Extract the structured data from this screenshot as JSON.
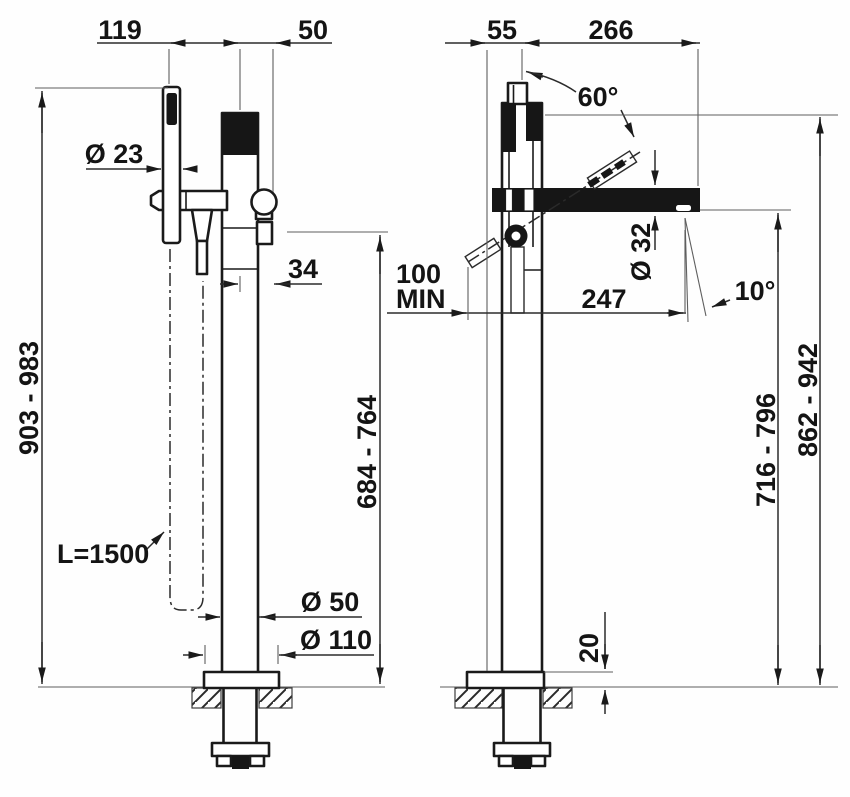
{
  "colors": {
    "ink": "#1a1a1a",
    "background": "#ffffff"
  },
  "dims": {
    "left": {
      "offset_handshower": "119",
      "offset_spout": "50",
      "dia_handshower": "Ø 23",
      "offset_outlet": "34",
      "height_total": "903 - 983",
      "height_spout": "684 - 764",
      "hose_length": "L=1500",
      "dia_column": "Ø 50",
      "dia_base": "Ø 110"
    },
    "right": {
      "offset_lever": "55",
      "reach_top": "266",
      "angle_lever": "60°",
      "dia_spout": "Ø 32",
      "clearance_value": "100",
      "clearance_qualifier": "MIN",
      "reach_spout": "247",
      "angle_spout": "10°",
      "height_underside": "716 - 796",
      "height_overall": "862 - 942",
      "base_thickness": "20"
    }
  }
}
